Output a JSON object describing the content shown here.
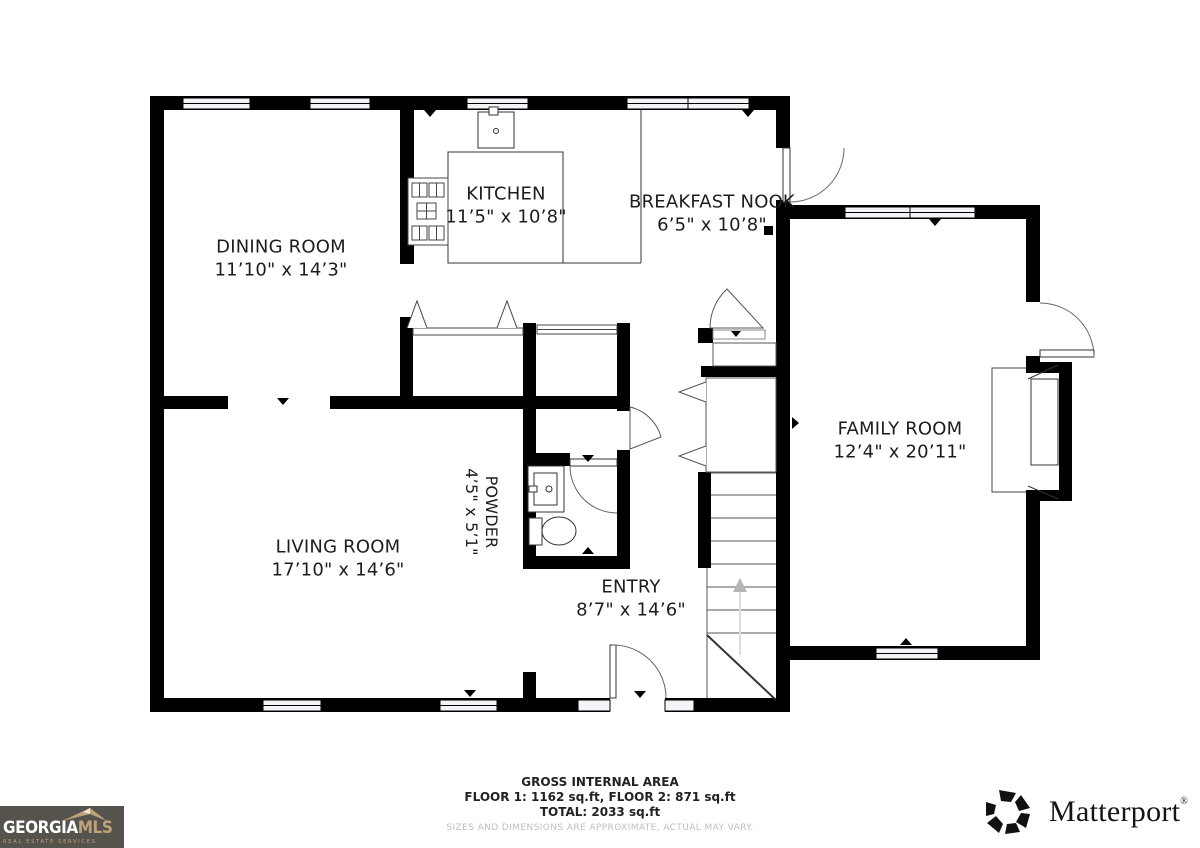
{
  "rooms": {
    "dining": {
      "name": "DINING ROOM",
      "dims": "11’10\" x 14’3\""
    },
    "kitchen": {
      "name": "KITCHEN",
      "dims": "11’5\" x 10’8\""
    },
    "breakfast": {
      "name": "BREAKFAST NOOK",
      "dims": "6’5\" x 10’8\""
    },
    "family": {
      "name": "FAMILY ROOM",
      "dims": "12’4\" x 20’11\""
    },
    "living": {
      "name": "LIVING ROOM",
      "dims": "17’10\" x 14’6\""
    },
    "powder": {
      "name": "POWDER",
      "dims": "4’5\" x 5’1\""
    },
    "entry": {
      "name": "ENTRY",
      "dims": "8’7\" x 14’6\""
    }
  },
  "footer": {
    "title": "GROSS INTERNAL AREA",
    "floors": "FLOOR 1: 1162 sq.ft, FLOOR 2: 871 sq.ft",
    "total": "TOTAL: 2033 sq.ft",
    "disclaimer": "SIZES AND DIMENSIONS ARE APPROXIMATE, ACTUAL MAY VARY."
  },
  "logos": {
    "georgia_mls": {
      "name_part1": "GEORGIA",
      "name_part2": "MLS",
      "tagline": "REAL ESTATE SERVICES",
      "bg_color": "#56524c",
      "accent_color": "#bda37c"
    },
    "matterport": {
      "wordmark": "Matterport",
      "registered_mark": "®"
    }
  },
  "colors": {
    "walls": "#000000",
    "thin_lines": "#444444",
    "stair_arrow": "#b5b5b5",
    "disclaimer_text": "#bfbfbf"
  }
}
